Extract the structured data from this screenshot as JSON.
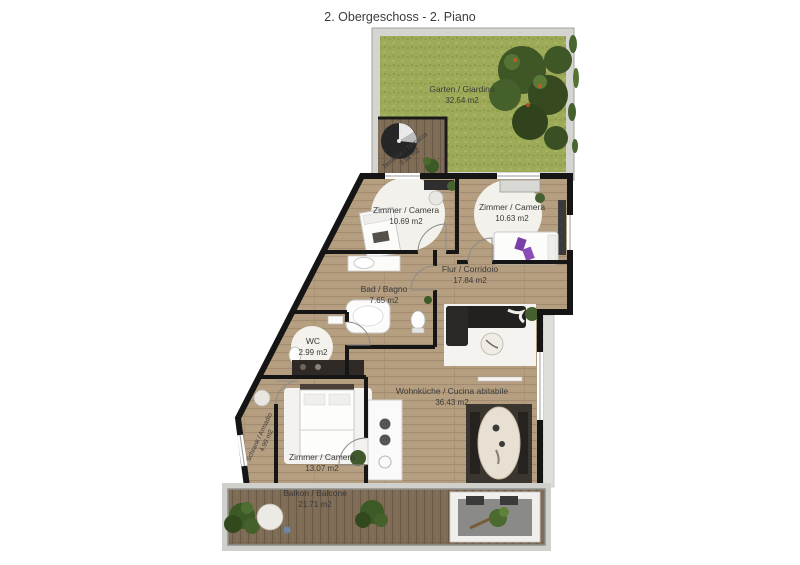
{
  "title": "2. Obergeschoss - 2. Piano",
  "rooms": {
    "garden": {
      "label": "Garten / Giardino",
      "area": "32.54 m2"
    },
    "terrace": {
      "label": "Terrasse / Terrazza",
      "area": "3.66 m2"
    },
    "bedroom1": {
      "label": "Zimmer / Camera",
      "area": "10.69 m2"
    },
    "bedroom2": {
      "label": "Zimmer / Camera",
      "area": "10.63 m2"
    },
    "corridor": {
      "label": "Flur / Corridoio",
      "area": "17.84 m2"
    },
    "bathroom": {
      "label": "Bad / Bagno",
      "area": "7.65 m2"
    },
    "wc": {
      "label": "WC",
      "area": "2.99 m2"
    },
    "closet": {
      "label": "Schrank / Armadio",
      "area": "4.99 m2"
    },
    "bedroom3": {
      "label": "Zimmer / Camera",
      "area": "13.07 m2"
    },
    "living": {
      "label": "Wohnküche / Cucina abitabile",
      "area": "36.43 m2"
    },
    "balcony": {
      "label": "Balkon / Balcone",
      "area": "21.71 m2"
    }
  },
  "colors": {
    "grass": "#9dab58",
    "wood_floor": "#b59e80",
    "deck_wood": "#7f6c56",
    "wall": "#161616",
    "tree": "#3f5626",
    "rug": "#f3f1ec",
    "label_text": "#3a3a3a"
  }
}
